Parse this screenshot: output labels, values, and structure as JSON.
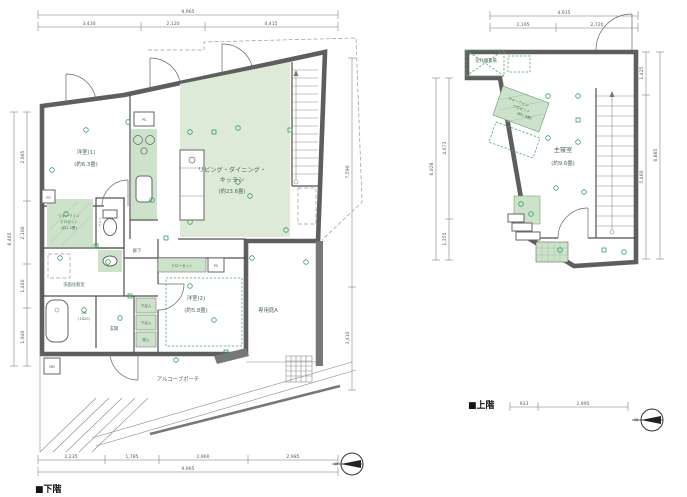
{
  "lower": {
    "caption": "■下階",
    "dims": {
      "top_total": "9,965",
      "top": [
        "3,430",
        "2,120",
        "4,415"
      ],
      "bottom_total": "9,965",
      "bottom": [
        "2,235",
        "1,785",
        "2,960",
        "2,985"
      ],
      "left_total": "8,465",
      "left": [
        "2,965",
        "2,100",
        "1,460",
        "1,940"
      ],
      "right": [
        "7,590",
        "3,410"
      ]
    },
    "rooms": {
      "yoshitsu1": {
        "name": "洋室(1)",
        "size": "(約6.3畳)"
      },
      "ldk": {
        "name1": "リビング・ダイニング・",
        "name2": "キッチン",
        "size": "(約23.6畳)"
      },
      "yoshitsu2": {
        "name": "洋室(2)",
        "size": "(約5.8畳)"
      },
      "closet": "クローゼット",
      "wic1": "ウォークイン",
      "wic2": "クロゼット",
      "wic_size": "(約1.2畳)",
      "toilet": "トイレ",
      "washroom": "洗面化粧室",
      "hallway": "廊下",
      "bath": "UB",
      "bath_size": "(1620)",
      "entrance": "玄関",
      "shoe": "下足入",
      "storage": "物入",
      "garden": "専用庭A",
      "porch": "アルコーブポーチ",
      "ps": "PS",
      "mb": "MB"
    }
  },
  "upper": {
    "caption": "■上階",
    "dims": {
      "top_total": "4,915",
      "top": [
        "2,195",
        "2,720"
      ],
      "left_total": "6,028",
      "left": [
        "4,673",
        "1,355"
      ],
      "right_total": "6,885",
      "right": [
        "1,425",
        "5,460"
      ],
      "bottom": [
        "933",
        "2,995"
      ]
    },
    "rooms": {
      "bedroom": {
        "name": "主寝室",
        "size": "(約9.6畳)"
      },
      "wic1": "ウォークイン",
      "wic2": "クロゼット",
      "wic_size": "(約1.9畳)",
      "outdoor": "室外機置場"
    }
  },
  "compass": "N"
}
